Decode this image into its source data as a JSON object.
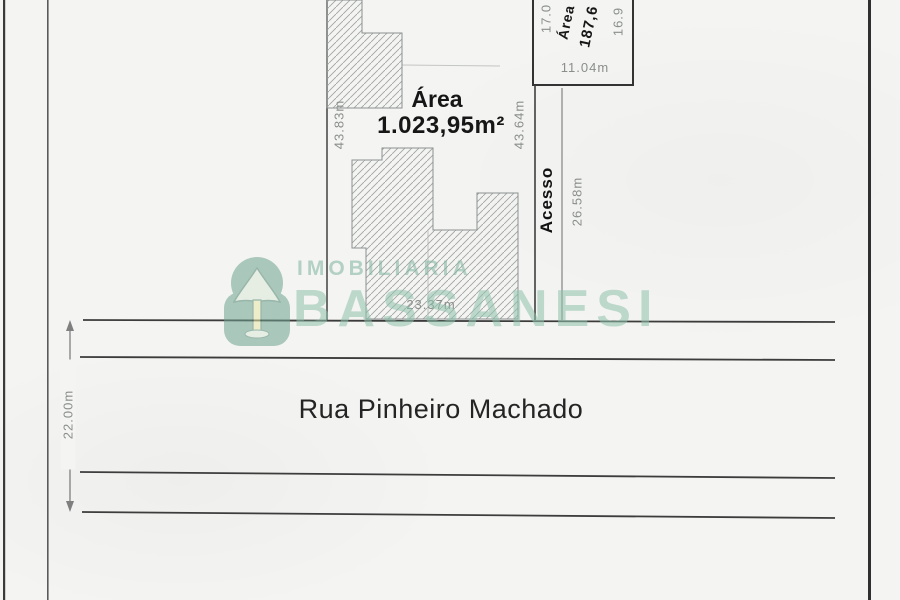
{
  "main_lot": {
    "area_title": "Área",
    "area_value": "1.023,95m²",
    "side_left_dim": "43.83m",
    "side_right_dim": "43.64m",
    "front_dim": "23.37m"
  },
  "access_strip": {
    "label": "Acesso",
    "length_dim": "26.58m"
  },
  "upper_lot": {
    "area_title": "Área",
    "area_value_visible": "187,6",
    "side_left_dim_visible": "17.0",
    "side_right_dim_visible": "16.9",
    "bottom_dim": "11.04m"
  },
  "street": {
    "name": "Rua Pinheiro Machado",
    "width_dim": "22.00m"
  },
  "watermark": {
    "brand_top": "IMOBILIARIA",
    "brand_main": "BASSANESI",
    "logo_icon": "araucaria-pine-tree-badge",
    "color": "#96c6b2"
  },
  "colors": {
    "paper": "#f4f4f2",
    "line_dark": "#3a3a3a",
    "line_gray": "#8c8c8c",
    "text_dark": "#1c1c1c",
    "text_gray": "#8a8f8c",
    "hatch": "#a0a6a4",
    "watermark_green": "#96c6b2",
    "logo_green": "#6fa390"
  }
}
